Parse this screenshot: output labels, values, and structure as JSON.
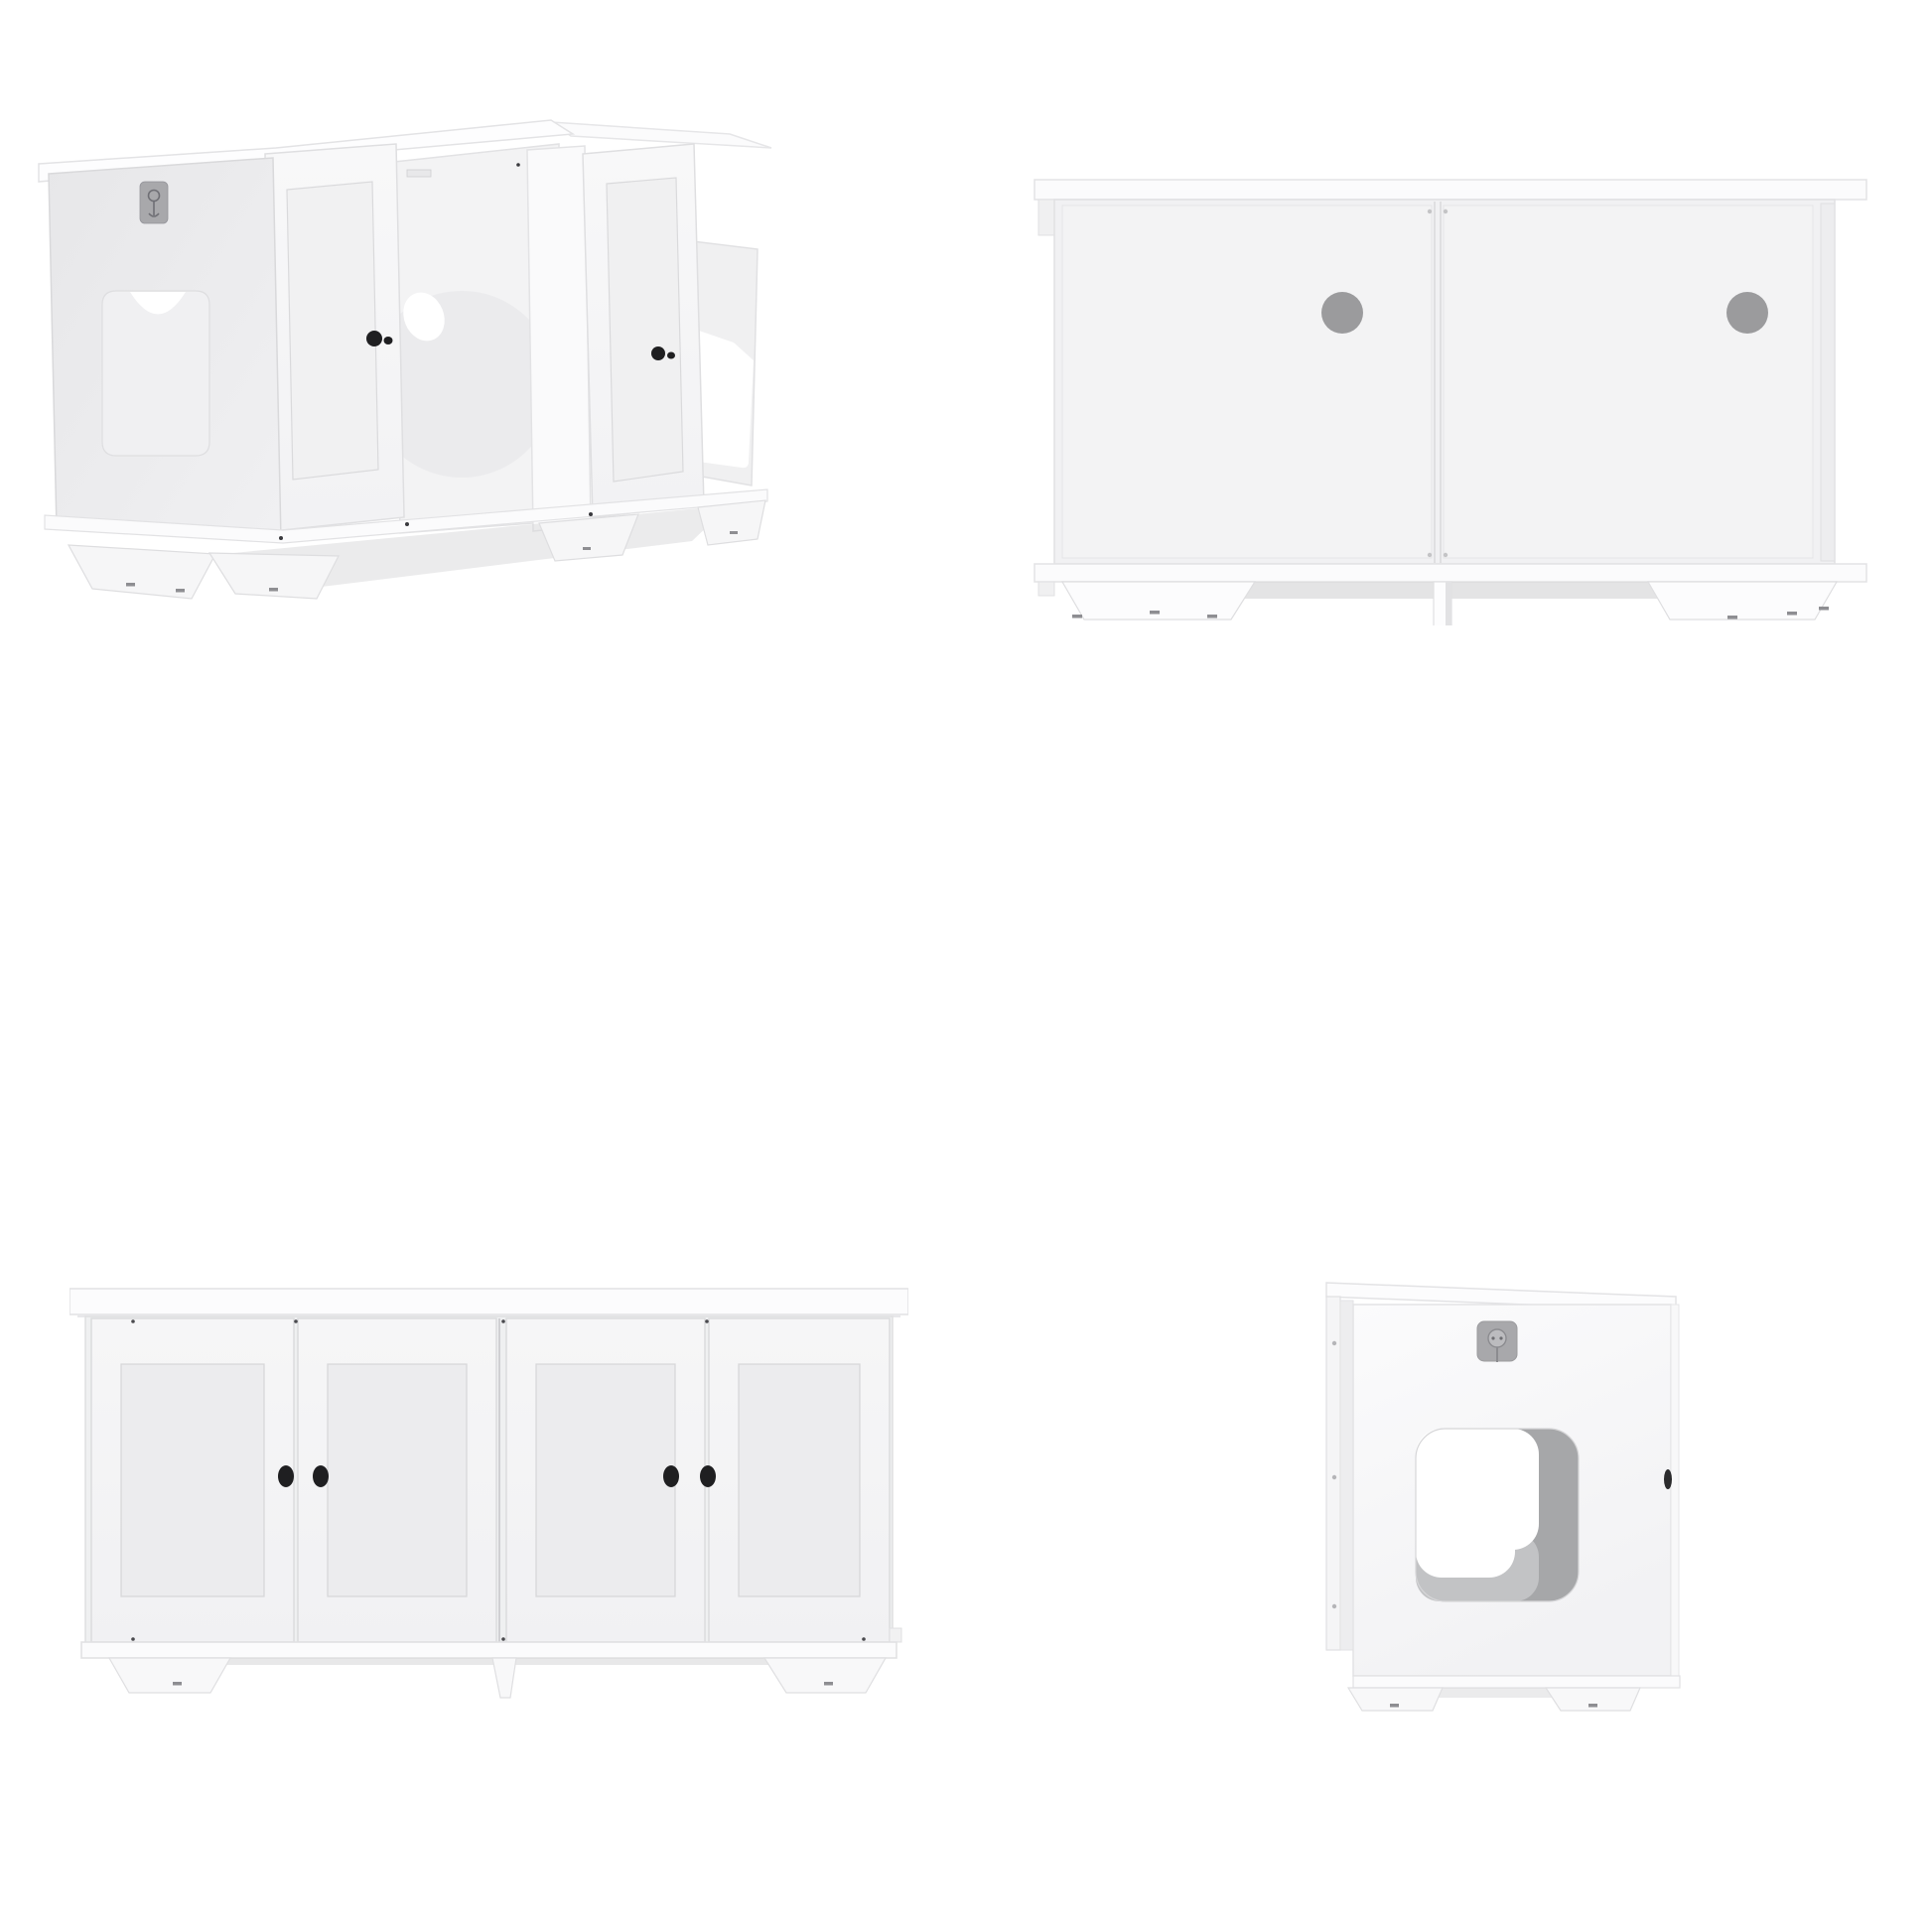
{
  "page": {
    "background": "#ffffff"
  },
  "gallery": {
    "product_name": "White double cat litter box enclosure cabinet, four product views",
    "views": [
      {
        "id": "perspective-open",
        "aria": "Angled perspective view of two-unit white cabinet with all doors open, side entry cutout and interior pass-through hole"
      },
      {
        "id": "back",
        "aria": "Back view of double cabinet with two round gray cord holes"
      },
      {
        "id": "front",
        "aria": "Front view of double cabinet with four shaker doors closed and black knobs"
      },
      {
        "id": "side",
        "aria": "Side view of single unit with rounded square pet entry opening and cord plaque"
      }
    ]
  },
  "colors": {
    "background": "#ffffff",
    "slab_white": "#fcfcfd",
    "panel_light": "#f2f2f3",
    "panel_shaded": "#e9e9ea",
    "edge": "#dfdfe1",
    "hole_gray": "#9b9b9d",
    "plaque_gray": "#a8a8ab",
    "glyph_gray": "#7d7d82",
    "knob_black": "#1f1f21",
    "cutout_wall": "#a6a7a9",
    "cutout_wall_light": "#c2c3c5",
    "shadow": "#d8d8da",
    "screw_dark": "#8e8e92"
  }
}
